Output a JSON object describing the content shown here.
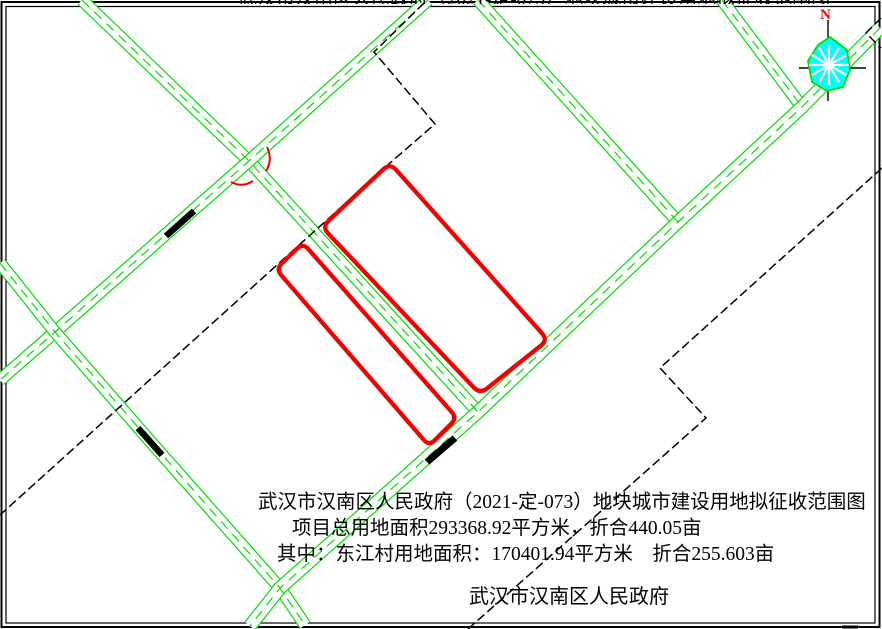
{
  "top_strip": {
    "clipped_text": "武汉市汉南区人民政府（2021-定-073）地块城市建设用地拟征收范围图"
  },
  "title_block": {
    "line1": "武汉市汉南区人民政府（2021-定-073）地块城市建设用地拟征收范围图",
    "line2": "项目总用地面积293368.92平方米，折合440.05亩",
    "line3": "其中：东江村用地面积：170401.94平方米　折合255.603亩",
    "signature": "武汉市汉南区人民政府"
  },
  "compass": {
    "label": "N",
    "label_color": "#ff0000",
    "label_pos": [
      820,
      19
    ],
    "fill": "#00ffff",
    "outline": "#00dd00",
    "center": [
      829,
      65
    ],
    "spokes": 12,
    "spoke_radius": 20,
    "blob": [
      [
        830,
        37
      ],
      [
        847,
        50
      ],
      [
        850,
        70
      ],
      [
        843,
        87
      ],
      [
        827,
        91
      ],
      [
        812,
        82
      ],
      [
        808,
        61
      ],
      [
        818,
        45
      ]
    ],
    "cross_v": [
      828,
      20,
      828,
      101
    ],
    "cross_h": [
      799,
      68,
      866,
      68
    ]
  },
  "map": {
    "colors": {
      "road": "#00dd00",
      "parcel": "#f20000",
      "boundary": "#000000",
      "frame": "#000000",
      "surface": "#ffffff"
    },
    "frame": {
      "outer": [
        1.5,
        2,
        878,
        625
      ],
      "inner": [
        6,
        6.5,
        869,
        616.5
      ]
    },
    "roads": [
      {
        "id": "road-between-parcels",
        "pts": [
          [
            82,
            0
          ],
          [
            249,
            161
          ],
          [
            478,
            412
          ]
        ],
        "w": 13
      },
      {
        "id": "road-upper-ne-sw",
        "pts": [
          [
            428,
            0
          ],
          [
            249,
            161
          ],
          [
            55,
            332
          ],
          [
            0,
            380
          ]
        ],
        "w": 13
      },
      {
        "id": "road-left-nw-se",
        "pts": [
          [
            0,
            263
          ],
          [
            55,
            332
          ],
          [
            150,
            441
          ],
          [
            280,
            588
          ],
          [
            305,
            625
          ]
        ],
        "w": 13
      },
      {
        "id": "road-top-branch",
        "pts": [
          [
            478,
            0
          ],
          [
            678,
            222
          ]
        ],
        "w": 13
      },
      {
        "id": "road-corner-branch",
        "pts": [
          [
            722,
            0
          ],
          [
            802,
            107
          ]
        ],
        "w": 13
      },
      {
        "id": "road-main-ne-sw",
        "pts": [
          [
            880,
            28
          ],
          [
            802,
            107
          ],
          [
            678,
            222
          ],
          [
            478,
            412
          ],
          [
            280,
            588
          ],
          [
            250,
            626
          ]
        ],
        "w": 14
      }
    ],
    "centerline_dash": "10 7",
    "boundaries": [
      {
        "pts": [
          [
            424,
            3
          ],
          [
            374,
            52
          ],
          [
            435,
            124
          ],
          [
            390,
            163
          ],
          [
            0,
            515
          ]
        ]
      },
      {
        "pts": [
          [
            881,
            18
          ],
          [
            866,
            33
          ],
          [
            881,
            48
          ]
        ]
      },
      {
        "pts": [
          [
            882,
            168
          ],
          [
            660,
            368
          ],
          [
            706,
            418
          ],
          [
            468,
            629
          ]
        ]
      }
    ],
    "boundary_dash": "9 4",
    "bars": [
      [
        166,
        236,
        194,
        211,
        6.5
      ],
      [
        138,
        428,
        162,
        455,
        6.5
      ],
      [
        427,
        462,
        455,
        438,
        7
      ]
    ],
    "parcels": [
      {
        "id": "parcel-large",
        "pts": [
          [
            390,
            163
          ],
          [
            548,
            340
          ],
          [
            480,
            394
          ],
          [
            322,
            227
          ]
        ],
        "r": 9
      },
      {
        "id": "parcel-small",
        "pts": [
          [
            303,
            243
          ],
          [
            457,
            418
          ],
          [
            429,
            446
          ],
          [
            276,
            269
          ]
        ],
        "r": 8
      }
    ],
    "parcel_stroke": 4.3,
    "red_arcs": [
      "M267,147 Q273,160 266,171",
      "M231,182 Q242,188 253,181"
    ],
    "edge_marks": [
      [
        842,
        625.5,
        16,
        3
      ]
    ]
  }
}
